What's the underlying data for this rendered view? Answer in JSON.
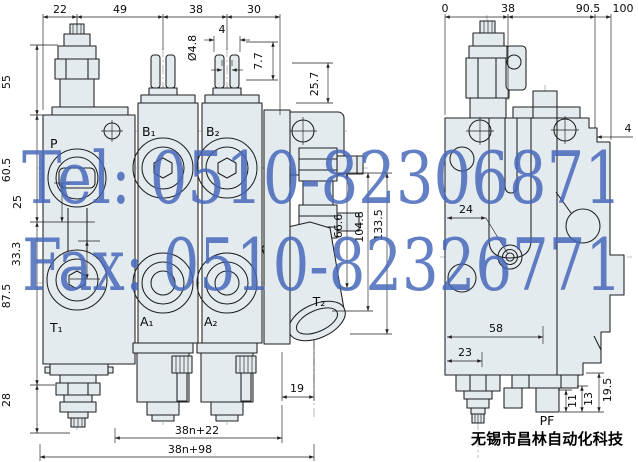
{
  "watermark": {
    "tel": "Tel: 0510-82306871",
    "fax": "Fax: 0510-82326771",
    "color": "#4668bb"
  },
  "company": {
    "name": "无锡市昌林自动化科技"
  },
  "colors": {
    "body_fill": "#e4ebef",
    "line": "#1f1f1f",
    "background": "#ffffff"
  },
  "front_view": {
    "ports": {
      "p": "P",
      "b1": "B₁",
      "b2": "B₂",
      "t1": "T₁",
      "a1": "A₁",
      "a2": "A₂",
      "t2": "T₂"
    },
    "dims": {
      "top": [
        "22",
        "49",
        "38",
        "30"
      ],
      "left": [
        "55",
        "60.5",
        "25",
        "33.3",
        "87.5",
        "28"
      ],
      "detail": [
        "Ø4.8",
        "4",
        "7.7",
        "25.7",
        "66.6",
        "104.8",
        "133.5",
        "19"
      ],
      "bottom": [
        "38n+22",
        "38n+98"
      ]
    }
  },
  "side_view": {
    "port": "PF",
    "dims": {
      "top": [
        "0",
        "38",
        "90.5",
        "100"
      ],
      "step": "4",
      "inner": [
        "24",
        "58",
        "23"
      ],
      "bottom": [
        "11",
        "13",
        "19.5"
      ]
    }
  }
}
